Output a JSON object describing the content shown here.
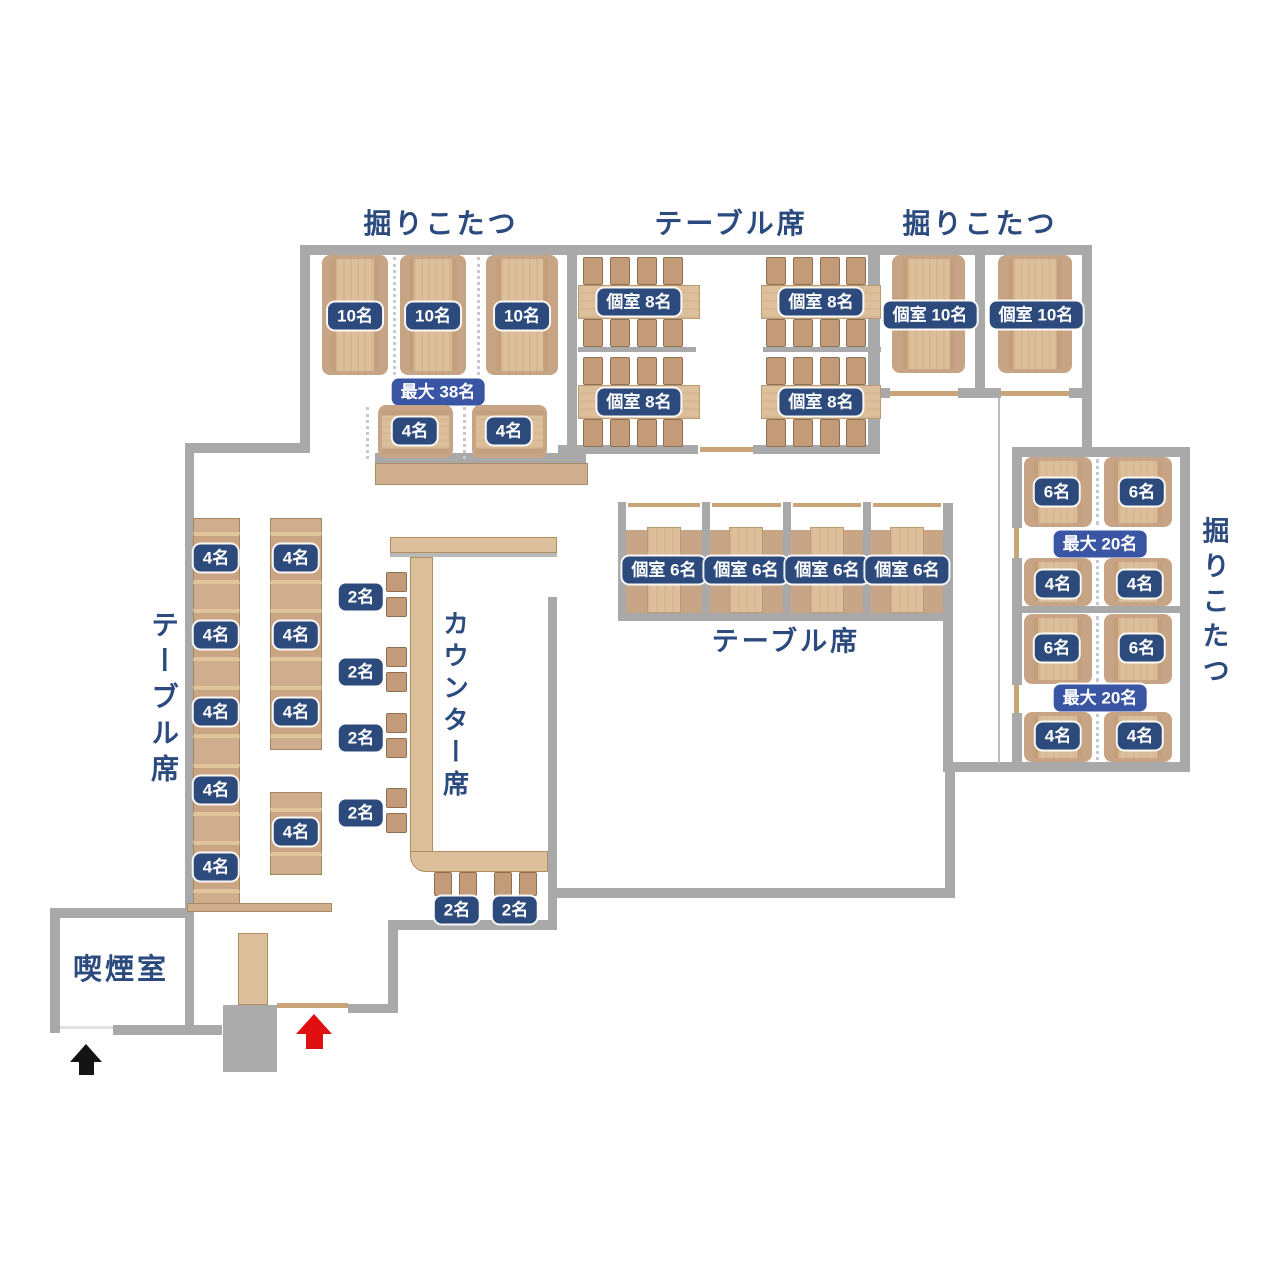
{
  "colors": {
    "wall": "#a9a9a9",
    "navy": "#2c4a7c",
    "blue": "#3b55a5",
    "title": "#2b4a7e",
    "wood": "#dcbf9b",
    "pad": "#c8a486",
    "bench": "#cfae8e",
    "chair": "#c49b78",
    "red": "#e01010",
    "black": "#141414"
  },
  "areas": {
    "kotatsu_tl": {
      "title": "掘りこたつ",
      "tables": [
        "10名",
        "10名",
        "10名"
      ],
      "max": "最大 38名",
      "small": [
        "4名",
        "4名"
      ]
    },
    "table_top": {
      "title": "テーブル席",
      "tables": [
        "個室 8名",
        "個室 8名",
        "個室 8名",
        "個室 8名"
      ]
    },
    "kotatsu_tr": {
      "title": "掘りこたつ",
      "tables": [
        "個室 10名",
        "個室 10名"
      ]
    },
    "kotatsu_r": {
      "title": "掘りこたつ",
      "groups": [
        {
          "large": [
            "6名",
            "6名"
          ],
          "max": "最大 20名",
          "small": [
            "4名",
            "4名"
          ]
        },
        {
          "large": [
            "6名",
            "6名"
          ],
          "max": "最大 20名",
          "small": [
            "4名",
            "4名"
          ]
        }
      ]
    },
    "private_mid": {
      "title": "テーブル席",
      "rooms": [
        "個室 6名",
        "個室 6名",
        "個室 6名",
        "個室 6名"
      ]
    },
    "table_left": {
      "title": "テーブル席",
      "col1": [
        "4名",
        "4名",
        "4名",
        "4名",
        "4名"
      ],
      "col2": [
        "4名",
        "4名",
        "4名"
      ],
      "col2_lower": "4名"
    },
    "counter": {
      "title": "カウンター席",
      "pairs": [
        "2名",
        "2名",
        "2名",
        "2名"
      ],
      "bottom_pairs": [
        "2名",
        "2名"
      ]
    },
    "smoking": {
      "title": "喫煙室"
    }
  },
  "icons": {
    "entrance": "red-up-arrow",
    "smoking_entrance": "black-up-arrow"
  }
}
